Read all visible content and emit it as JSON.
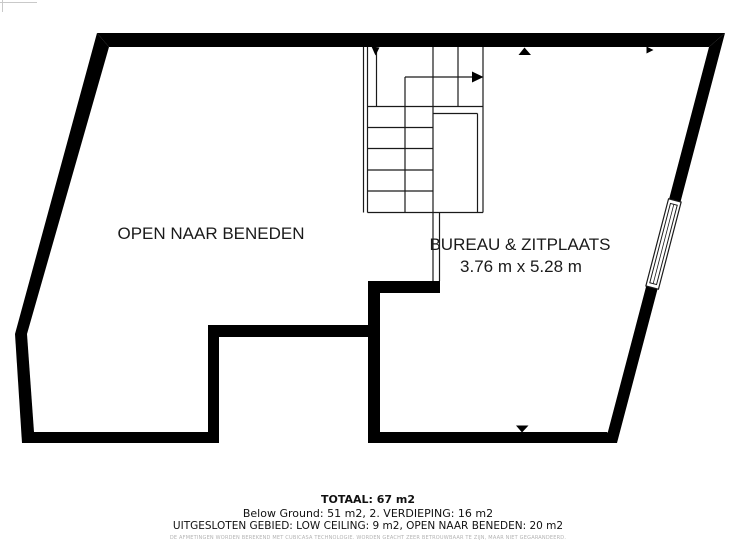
{
  "plan": {
    "rooms": {
      "open_naar_beneden": {
        "label": "OPEN NAAR BENEDEN"
      },
      "bureau": {
        "label": "BUREAU & ZITPLAATS",
        "dimensions": "3.76 m x 5.28 m"
      }
    },
    "icons": {
      "stairs-direction-arrow": "right-arrow",
      "stairs-start-arrow": "small-arrowhead",
      "wall-marker-top": "up-triangle",
      "wall-marker-right": "right-triangle",
      "wall-marker-bottom": "down-triangle",
      "window": "double-line-window"
    },
    "colors": {
      "wall": "#000000",
      "thin_line": "#1a1a1a",
      "background": "#ffffff",
      "disclaimer_gray": "#b3b3b3"
    }
  },
  "summary": {
    "total": "TOTAAL: 67 m2",
    "floors": "Below Ground: 51 m2, 2. VERDIEPING: 16 m2",
    "excluded": "UITGESLOTEN GEBIED: LOW CEILING: 9 m2, OPEN NAAR BENEDEN: 20 m2",
    "disclaimer": "DE AFMETINGEN WORDEN BEREKEND MET CUBICASA TECHNOLOGIE. WORDEN GEACHT ZEER BETROUWBAAR TE ZIJN, MAAR NIET GEGARANDEERD."
  }
}
